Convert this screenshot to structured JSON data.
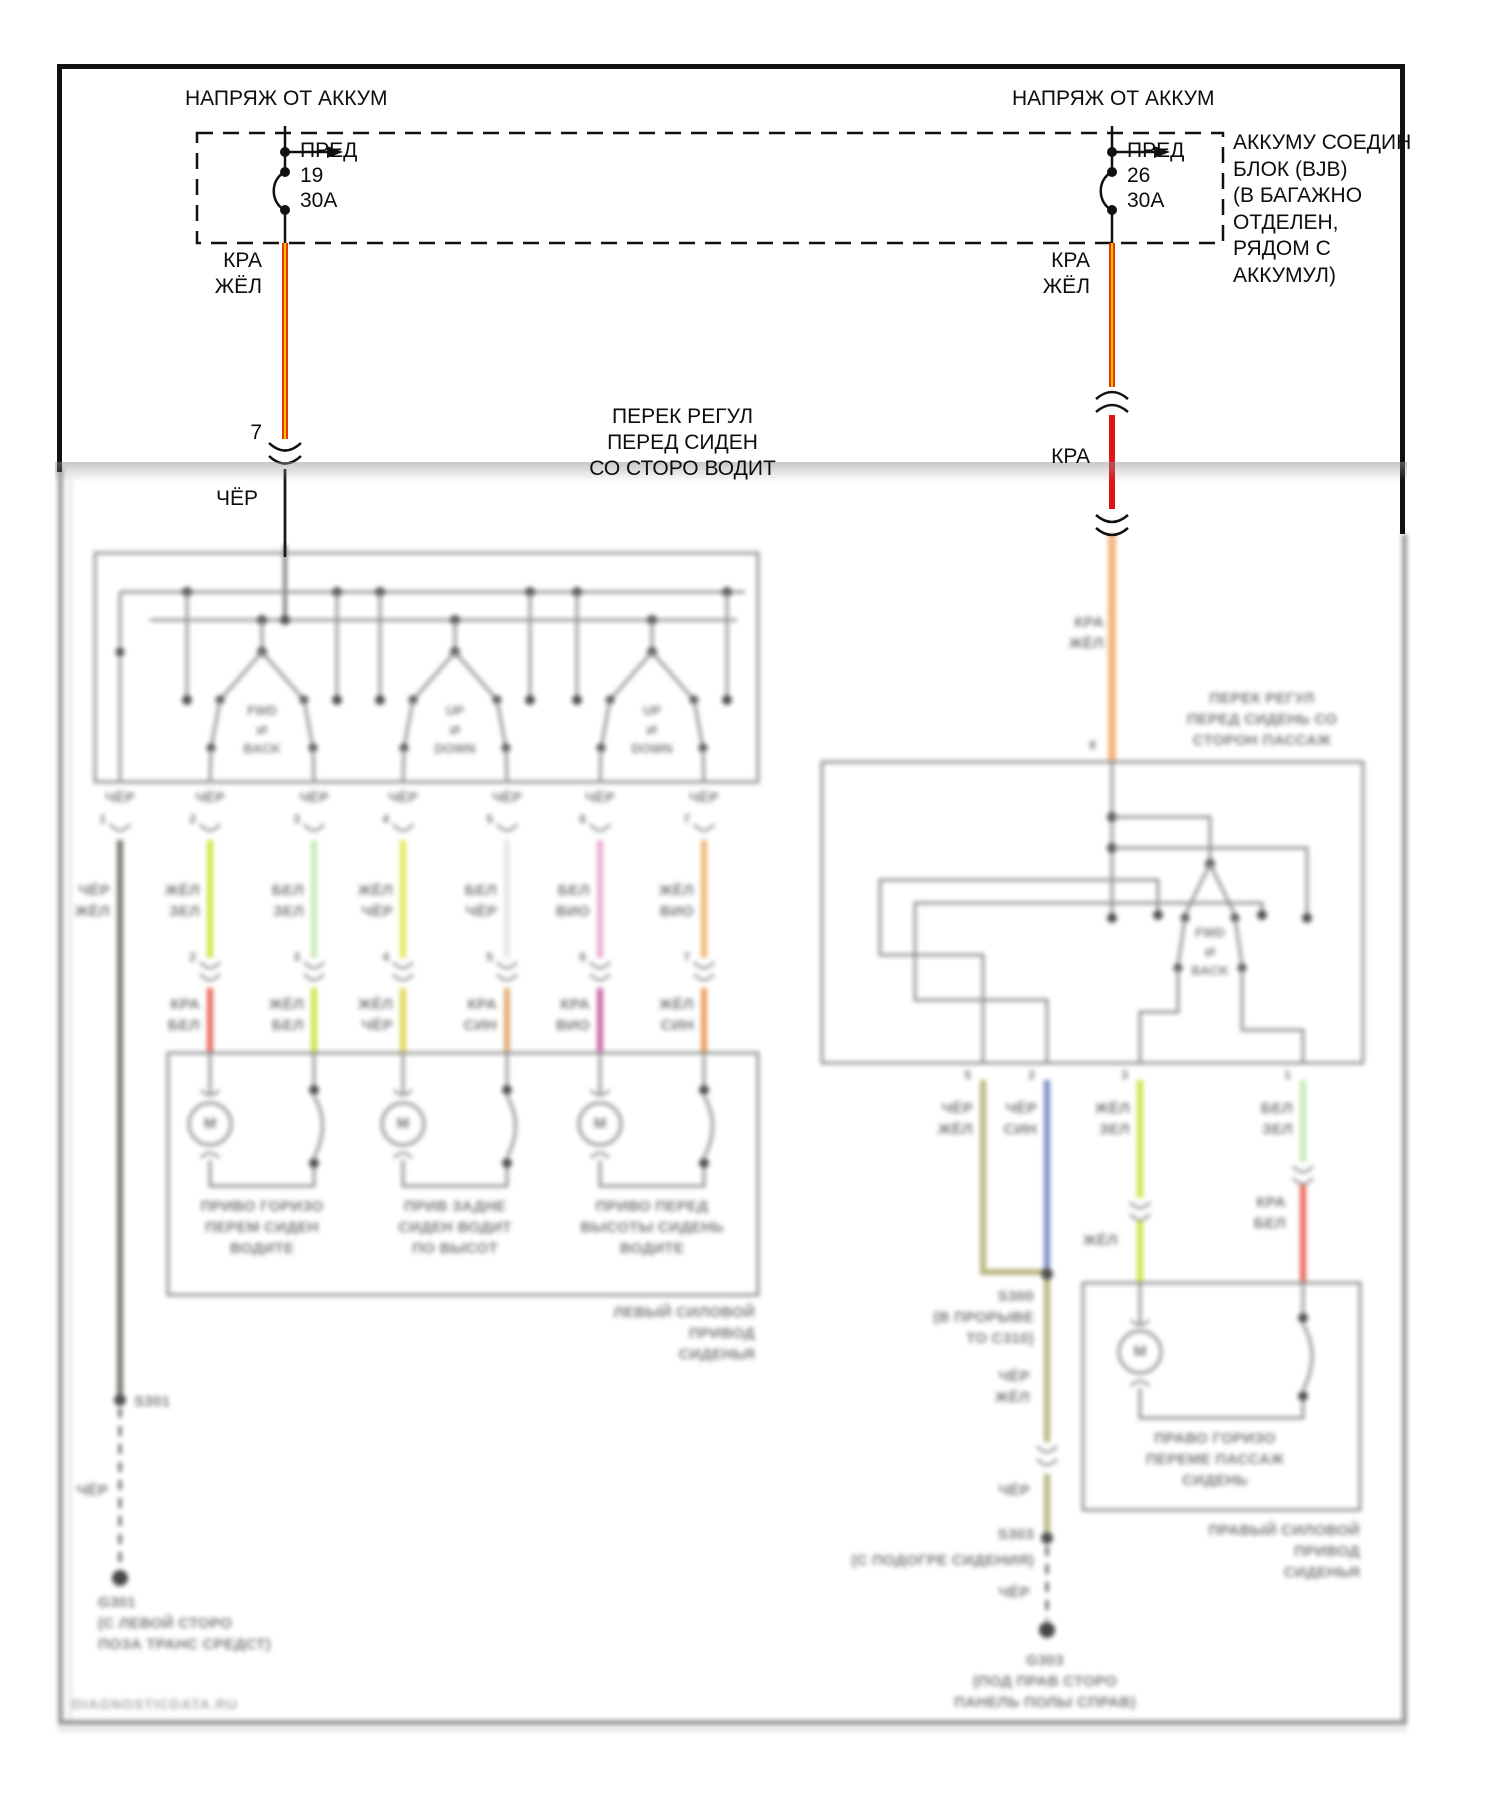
{
  "page": {
    "watermark": "DIAGNOSTICDATA.RU"
  },
  "colors": {
    "wire_red_yellow_outer": "#e43a00",
    "wire_red_yellow_core": "#ffd400",
    "wire_red": "#e01616",
    "wire_black": "#1a1a1a",
    "wire_orange_faded": "#f2b077",
    "wire_yellow_green": "#cde23c",
    "wire_pale_green": "#c6e7b2",
    "wire_yellow": "#e6e65a",
    "wire_white": "#e4e4e4",
    "wire_pink": "#eaa6cf",
    "wire_orange": "#eeb36e",
    "wire_olive": "#b3b378",
    "wire_blue": "#7585bd",
    "wire_magenta": "#c75fa4",
    "wire_tan": "#dfa76a",
    "schematic_gray": "#8f8f8f"
  },
  "feeds": {
    "left": {
      "title": "НАПРЯЖ ОТ АККУМ",
      "fuse_name": "ПРЕД",
      "fuse_num": "19",
      "fuse_amp": "30А",
      "wire1_l1": "КРА",
      "wire1_l2": "ЖЁЛ",
      "pin": "7",
      "wire2": "ЧЁР"
    },
    "right": {
      "title": "НАПРЯЖ ОТ АККУМ",
      "fuse_name": "ПРЕД",
      "fuse_num": "26",
      "fuse_amp": "30А",
      "wire1_l1": "КРА",
      "wire1_l2": "ЖЁЛ",
      "wire2": "КРА",
      "wire3_l1": "КРА",
      "wire3_l2": "ЖЁЛ"
    },
    "bjb": [
      "АККУМУ СОЕДИН",
      "БЛОК (BJB)",
      "(В БАГАЖНО",
      "ОТДЕЛЕН,",
      "РЯДОМ С",
      "АККУМУЛ)"
    ]
  },
  "driver": {
    "label": [
      "ПЕРЕК РЕГУЛ",
      "ПЕРЕД СИДЕН",
      "СО СТОРО ВОДИТ"
    ],
    "switches": [
      {
        "t": "FWD",
        "m": "⇄",
        "b": "BACK"
      },
      {
        "t": "UP",
        "m": "⇄",
        "b": "DOWN"
      },
      {
        "t": "UP",
        "m": "⇄",
        "b": "DOWN"
      }
    ],
    "pin_wire": [
      "ЧЁР",
      "ЧЁР",
      "ЧЁР",
      "ЧЁР",
      "ЧЁР",
      "ЧЁР",
      "ЧЁР"
    ],
    "pins": [
      "1",
      "2",
      "3",
      "4",
      "5",
      "6",
      "7"
    ],
    "conn_pins": [
      "2",
      "3",
      "4",
      "5",
      "6",
      "7"
    ],
    "w1": {
      "a": "ЧЁР",
      "b": "ЖЁЛ"
    },
    "w2": {
      "a": "ЖЁЛ",
      "b": "ЗЕЛ",
      "c": "КРА",
      "d": "БЕЛ"
    },
    "w3": {
      "a": "БЕЛ",
      "b": "ЗЕЛ",
      "c": "ЖЁЛ",
      "d": "БЕЛ"
    },
    "w4": {
      "a": "ЖЁЛ",
      "b": "ЧЁР",
      "c": "ЖЁЛ",
      "d": "ЧЁР"
    },
    "w5": {
      "a": "БЕЛ",
      "b": "ЧЁР",
      "c": "КРА",
      "d": "СИН"
    },
    "w6": {
      "a": "БЕЛ",
      "b": "ВИО",
      "c": "КРА",
      "d": "ВИО"
    },
    "w7": {
      "a": "ЖЁЛ",
      "b": "ВИО",
      "c": "ЖЁЛ",
      "d": "СИН"
    },
    "motor_symbol": "М",
    "m1": [
      "ПРИВО ГОРИЗО",
      "ПЕРЕМ СИДЕН",
      "ВОДИТЕ"
    ],
    "m2": [
      "ПРИВ ЗАДНЕ",
      "СИДЕН ВОДИТ",
      "ПО ВЫСОТ"
    ],
    "m3": [
      "ПРИВО ПЕРЕД",
      "ВЫСОТЫ СИДЕНЬ",
      "ВОДИТЕ"
    ],
    "caption": [
      "ЛЕВЫЙ СИЛОВОЙ",
      "ПРИВОД",
      "СИДЕНЬЯ"
    ],
    "splice": "S301",
    "gnd_wire": "ЧЁР",
    "gnd": "G301",
    "gnd_loc": [
      "(С ЛЕВОЙ СТОРО",
      "ПОЗА ТРАНС СРЕДСТ)"
    ]
  },
  "passenger": {
    "label": [
      "ПЕРЕК РЕГУЛ",
      "ПЕРЕД СИДЕНЬ СО",
      "СТОРОН ПАССАЖ"
    ],
    "switch": {
      "t": "FWD",
      "m": "⇄",
      "b": "BACK"
    },
    "top_pin": "6",
    "pins": [
      "5",
      "2",
      "3",
      "1"
    ],
    "w1": {
      "a": "ЧЁР",
      "b": "ЖЁЛ"
    },
    "w2": {
      "a": "ЧЁР",
      "b": "СИН"
    },
    "w3": {
      "a": "ЖЁЛ",
      "b": "ЗЕЛ",
      "mid": "ЖЁЛ"
    },
    "w4": {
      "a": "БЕЛ",
      "b": "ЗЕЛ",
      "c": "КРА",
      "d": "БЕЛ"
    },
    "splice1": "S300",
    "splice1_loc": [
      "(В ПРОРЫВЕ",
      "ТО С310)"
    ],
    "after_splice": {
      "a": "ЧЁР",
      "b": "ЖЁЛ"
    },
    "conn_wire": "ЧЁР",
    "splice2": "S303",
    "splice2_loc": "(С ПОДОГРЕ СИДЕНИЯ)",
    "gnd_wire": "ЧЁР",
    "gnd": "G303",
    "gnd_loc": [
      "(ПОД ПРАВ СТОРО",
      "ПАНЕЛЬ ПОЛЫ СПРАВ)"
    ],
    "motor_symbol": "М",
    "m1": [
      "ПРАВО ГОРИЗО",
      "ПЕРЕМЕ ПАССАЖ",
      "СИДЕНЬ"
    ],
    "caption": [
      "ПРАВЫЙ СИЛОВОЙ",
      "ПРИВОД",
      "СИДЕНЬЯ"
    ]
  }
}
